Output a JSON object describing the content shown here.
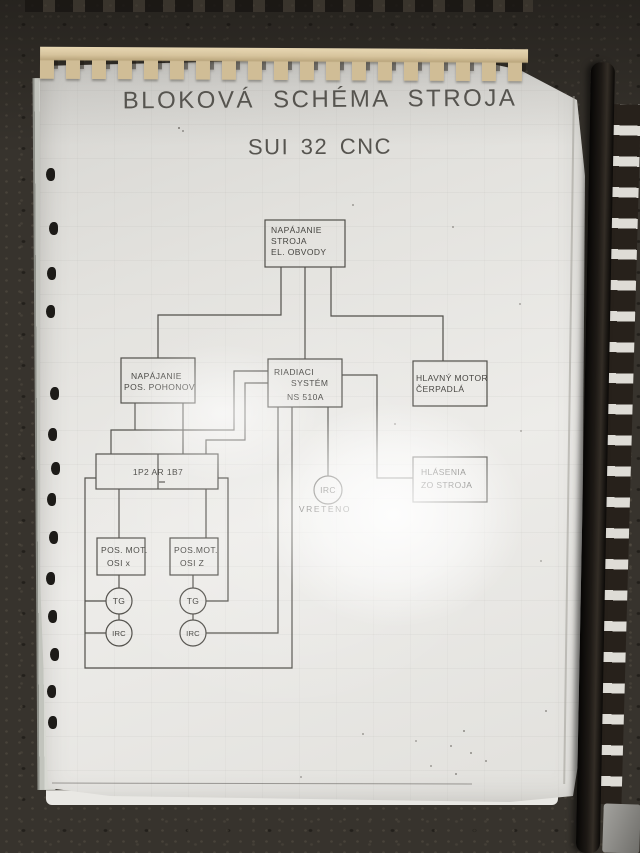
{
  "titles": {
    "line1": "BLOKOVÁ SCHÉMA STROJA",
    "line2": "SUI 32 CNC"
  },
  "diagram": {
    "boxes": [
      {
        "name": "napajanie-stroja",
        "lines": [
          "NAPÁJANIE",
          "STROJA",
          "EL. OBVODY"
        ]
      },
      {
        "name": "napajanie-pos-pohonov",
        "lines": [
          "NAPÁJANIE",
          "POS. POHONOV"
        ]
      },
      {
        "name": "riadiaci-system",
        "lines": [
          "RIADIACI",
          "SYSTÉM",
          "NS 510A"
        ]
      },
      {
        "name": "hlavny-motor-cerpadla",
        "lines": [
          "HLAVNÝ MOTOR",
          "ČERPADLÁ"
        ]
      },
      {
        "name": "hlasenia-zo-stroja",
        "lines": [
          "HLÁSENIA",
          "ZO STROJA"
        ]
      },
      {
        "name": "blok-1p2-ar-1b7",
        "lines": [
          "1P2 AR 1B7"
        ]
      },
      {
        "name": "pos-mot-osi-x",
        "lines": [
          "POS. MOT.",
          "OSI x"
        ]
      },
      {
        "name": "pos-mot-osi-z",
        "lines": [
          "POS.MOT.",
          "OSI Z"
        ]
      }
    ],
    "circles": [
      {
        "name": "tg-x",
        "label": "TG"
      },
      {
        "name": "irc-x",
        "label": "IRC"
      },
      {
        "name": "tg-z",
        "label": "TG"
      },
      {
        "name": "irc-z",
        "label": "IRC"
      },
      {
        "name": "irc-vreteno",
        "label": "IRC"
      }
    ],
    "captions": {
      "vreteno": "VRETENO"
    }
  },
  "colors": {
    "paper": "#e7e6e2",
    "ink": "#514f4a",
    "comb_tan": "#d6c39c",
    "book_spine_black": "#16130f",
    "carpet": "#37332d"
  }
}
